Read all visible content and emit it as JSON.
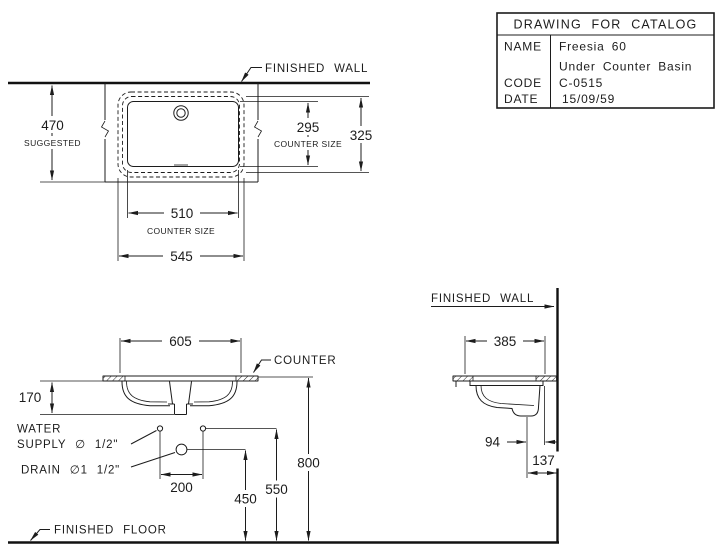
{
  "title_block": {
    "title": "DRAWING FOR CATALOG",
    "name_label": "NAME",
    "name_value_line1": "Freesia 60",
    "name_value_line2": "Under Counter Basin",
    "code_label": "CODE",
    "code_value": "C-0515",
    "date_label": "DATE",
    "date_value": "15/09/59"
  },
  "plan_view": {
    "finished_wall": "FINISHED WALL",
    "dim_470": {
      "value": "470",
      "note": "SUGGESTED"
    },
    "dim_295": {
      "value": "295",
      "note": "COUNTER SIZE"
    },
    "dim_325": "325",
    "dim_510": {
      "value": "510",
      "note": "COUNTER SIZE"
    },
    "dim_545": "545"
  },
  "front_view": {
    "dim_605": "605",
    "counter_label": "COUNTER",
    "dim_170": "170",
    "water_supply_line1": "WATER",
    "water_supply_line2": "SUPPLY ∅ 1/2\"",
    "drain_label": "DRAIN ∅1 1/2\"",
    "dim_200": "200",
    "dim_450": "450",
    "dim_550": "550",
    "dim_800": "800",
    "finished_floor": "FINISHED FLOOR"
  },
  "side_view": {
    "finished_wall": "FINISHED WALL",
    "dim_385": "385",
    "dim_94": "94",
    "dim_137": "137"
  }
}
